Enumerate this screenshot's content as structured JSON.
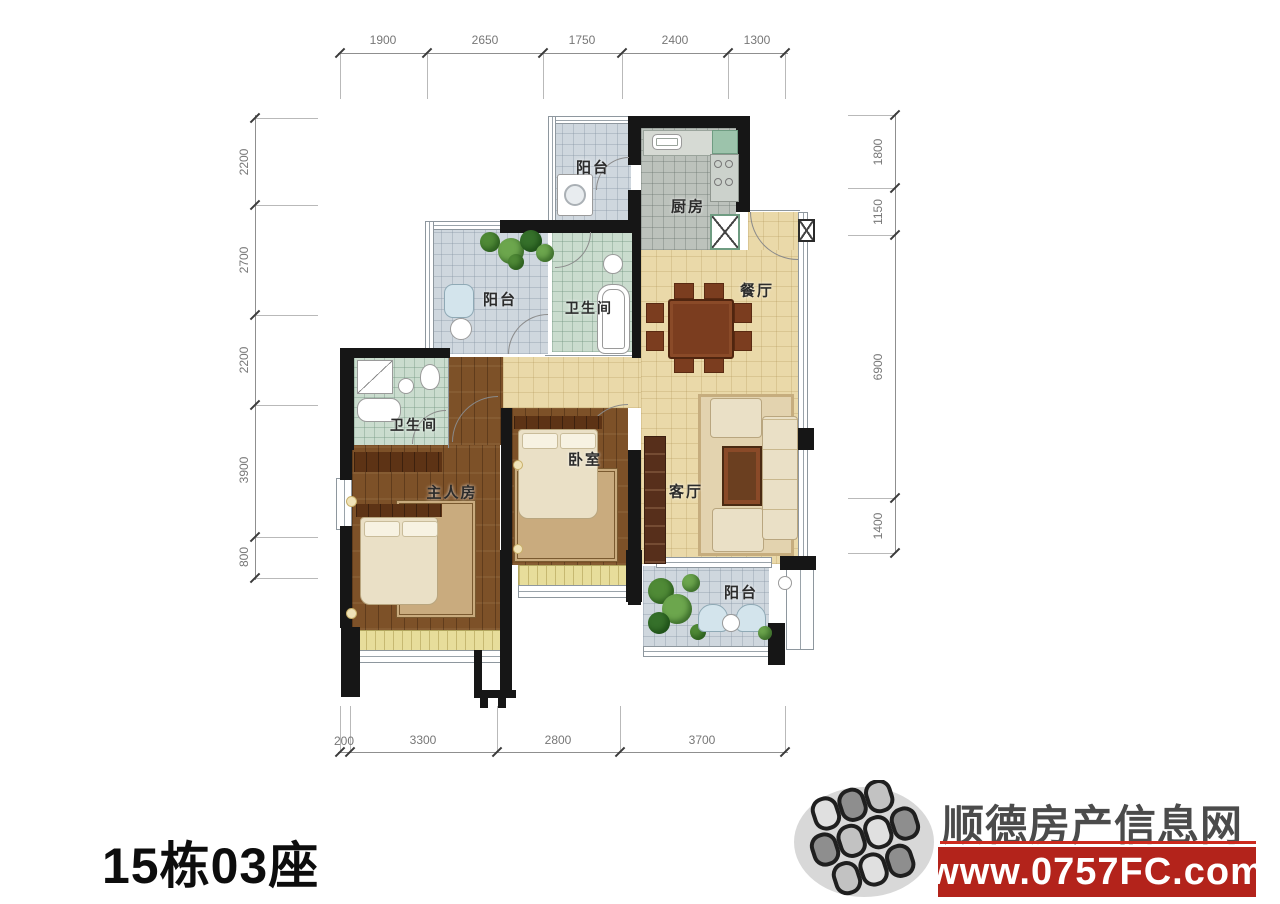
{
  "title": "15栋03座",
  "dimensions": {
    "top": [
      "1900",
      "2650",
      "1750",
      "2400",
      "1300"
    ],
    "bottom": [
      "200",
      "3300",
      "2800",
      "3700"
    ],
    "left": [
      "2200",
      "2700",
      "2200",
      "3900",
      "800"
    ],
    "right": [
      "1800",
      "1150",
      "6900",
      "1400"
    ]
  },
  "rooms": {
    "balcony_top": "阳台",
    "kitchen": "厨房",
    "dining": "餐厅",
    "balcony_mid": "阳台",
    "bath_top": "卫生间",
    "bath_left": "卫生间",
    "master": "主人房",
    "bedroom": "卧室",
    "living": "客厅",
    "balcony_bottom": "阳台"
  },
  "watermark": {
    "site_name": "顺德房产信息网",
    "site_url": "www.0757FC.com",
    "banner_color": "#b3231b",
    "underline_color": "#cc2a1e",
    "text_color": "#4b4b4b"
  }
}
